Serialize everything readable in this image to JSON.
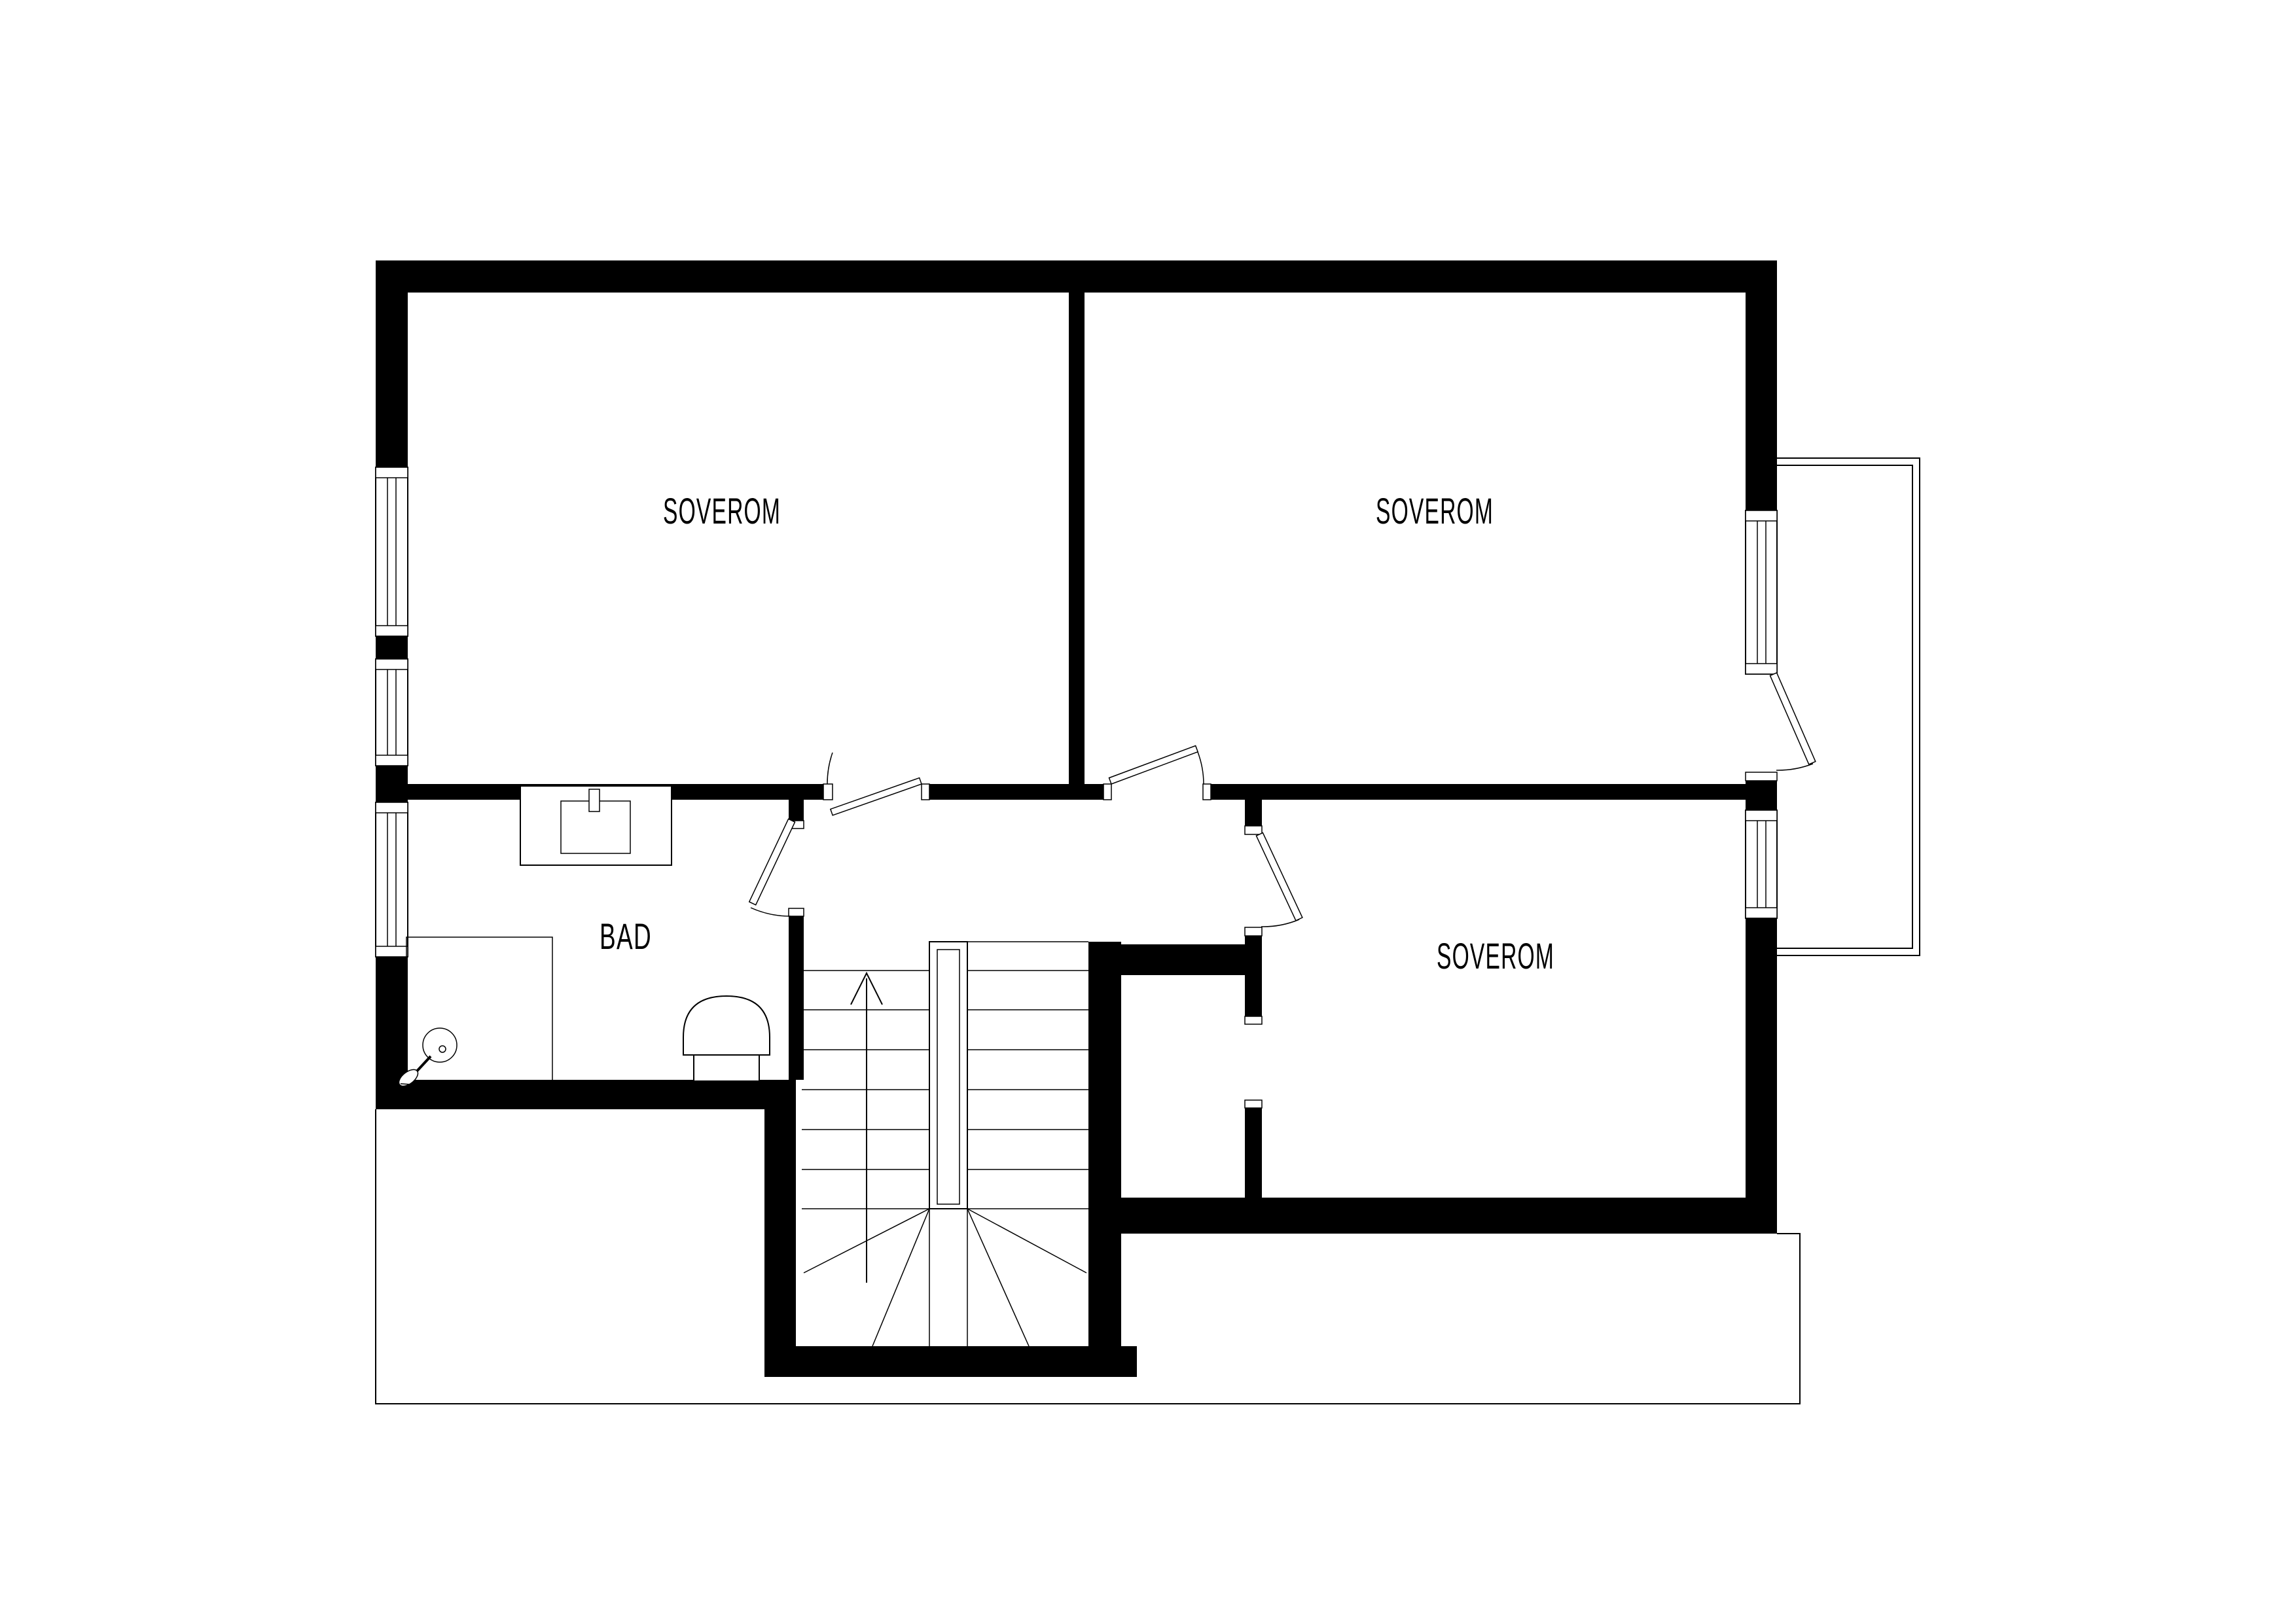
{
  "document": {
    "type": "architectural-floor-plan",
    "language": "Norwegian"
  },
  "colors": {
    "wall": "#000000",
    "line": "#000000",
    "background": "#ffffff"
  },
  "labels": {
    "bedroom_top_left": "SOVEROM",
    "bedroom_top_right": "SOVEROM",
    "bedroom_bottom_right": "SOVEROM",
    "bathroom": "BAD"
  },
  "rooms": [
    {
      "name": "bedroom-top-left",
      "label": "SOVEROM"
    },
    {
      "name": "bedroom-top-right",
      "label": "SOVEROM"
    },
    {
      "name": "bedroom-bottom-right",
      "label": "SOVEROM"
    },
    {
      "name": "bathroom",
      "label": "BAD"
    },
    {
      "name": "hall-with-stairs",
      "label": ""
    },
    {
      "name": "balcony",
      "label": ""
    }
  ],
  "icons": [
    "stairs-icon",
    "up-arrow-icon",
    "toilet-icon",
    "sink-icon",
    "shower-head-icon",
    "shower-enclosure",
    "window-icon",
    "door-swing-icon",
    "balcony-railing",
    "lower-roof-outline"
  ]
}
